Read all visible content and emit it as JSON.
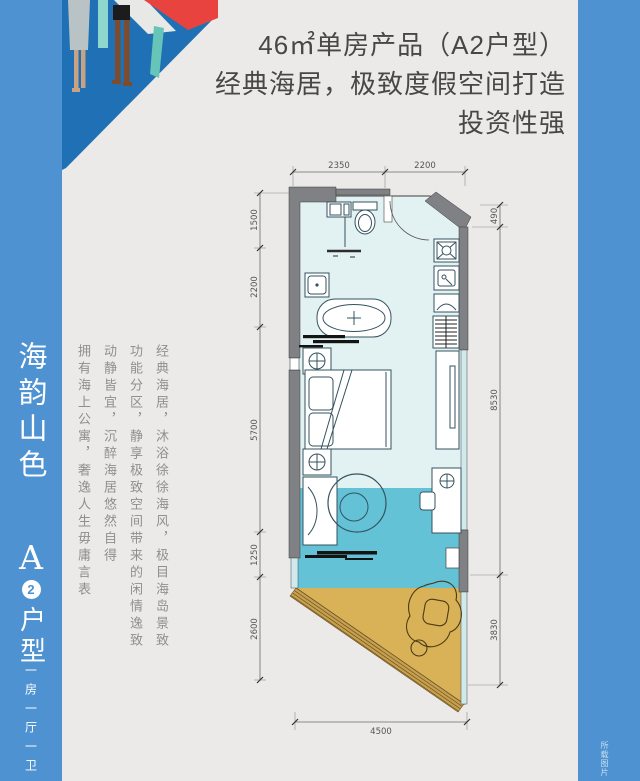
{
  "page": {
    "background": "#ebeae8",
    "accent_blue": "#4e92d1",
    "floor_indoor": "#e2f2f3",
    "floor_living": "#63c2d6",
    "floor_balcony": "#d9b257",
    "wall_gray": "#7f8184",
    "umbrella_red": "#e8433e",
    "illustration_blue": "#1f70b4"
  },
  "headline": {
    "line1": "46㎡单房产品（A2户型）",
    "line2": "经典海居，极致度假空间打造",
    "line3": "投资性强"
  },
  "left_banner": {
    "title": "海韵山色",
    "unit_letter": "A",
    "unit_number": "2",
    "unit_suffix": "户型",
    "subtitle": "一房一厅一卫"
  },
  "description": {
    "col1": "经典海居，沐浴徐徐海风，极目海岛景致",
    "col2": "功能分区，静享极致空间带来的闲情逸致",
    "col3": "动静皆宜，沉醉海居悠然自得",
    "col4": "拥有海上公寓，奢逸人生毋庸言表"
  },
  "floorplan": {
    "dims": {
      "top": [
        "2350",
        "2200"
      ],
      "left": [
        "1500",
        "2200",
        "5700",
        "1250",
        "2600"
      ],
      "right": [
        "490",
        "8530",
        "3830"
      ],
      "bottom": [
        "4500"
      ]
    }
  },
  "watermark": "所载图片"
}
